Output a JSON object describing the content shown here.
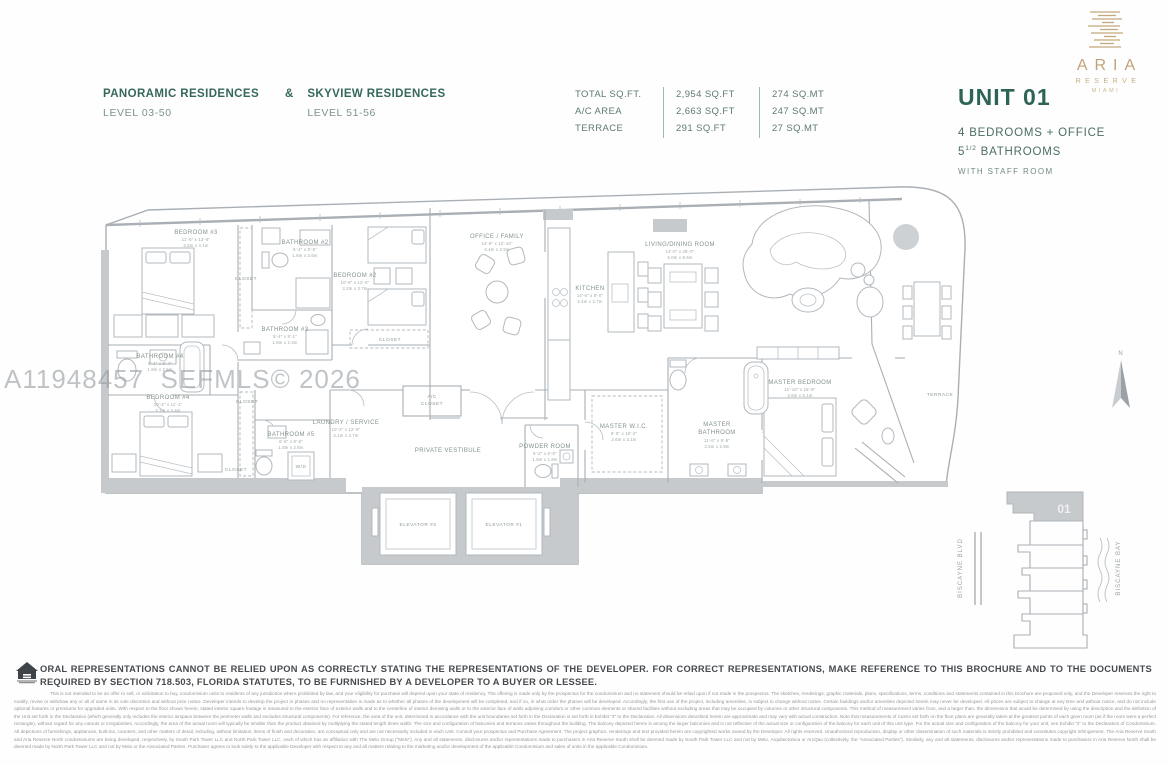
{
  "header": {
    "left": {
      "title1": "PANORAMIC RESIDENCES",
      "amp": "&",
      "title2": "SKYVIEW RESIDENCES",
      "sub1": "LEVEL 03-50",
      "sub2": "LEVEL 51-56"
    },
    "area_table": {
      "rows": [
        {
          "label": "TOTAL SQ.FT.",
          "sqft": "2,954 SQ.FT",
          "sqmt": "274 SQ.MT"
        },
        {
          "label": "A/C AREA",
          "sqft": "2,663 SQ.FT",
          "sqmt": "247 SQ.MT"
        },
        {
          "label": "TERRACE",
          "sqft": "291 SQ.FT",
          "sqmt": "27 SQ.MT"
        }
      ]
    },
    "brand": {
      "name": "ARIA",
      "reserve": "RESERVE",
      "city": "MIAMI",
      "gold": "#c3a87c"
    },
    "unit": {
      "title": "UNIT 01",
      "line1": "4 BEDROOMS + OFFICE",
      "line2_num": "5",
      "line2_frac": "1/2",
      "line2_rest": " BATHROOMS",
      "line3": "WITH STAFF ROOM",
      "accent": "#2e6456"
    }
  },
  "watermark": "A11948457  SEFMLS© 2026",
  "plan": {
    "rooms": {
      "b3": {
        "label": "BEDROOM #3",
        "ft": "11'-6\" x 13'-6\"",
        "m": "3.5m x 4.1m"
      },
      "ba2": {
        "label": "BATHROOM #2",
        "ft": "5'-4\" x 8'-6\"",
        "m": "1.6m x 2.6m"
      },
      "clo1": {
        "label": "CLOSET"
      },
      "ba3": {
        "label": "BATHROOM #3",
        "ft": "5'-4\" x 8'-1\"",
        "m": "1.6m x 2.4m"
      },
      "b2": {
        "label": "BEDROOM #2",
        "ft": "10'-8\" x 12'-0\"",
        "m": "3.2m x 3.7m"
      },
      "clo2": {
        "label": "CLOSET"
      },
      "ba4": {
        "label": "BATHROOM #4",
        "ft": "6'-1\" x 8'-4\"",
        "m": "1.9m x 2.5m"
      },
      "b4": {
        "label": "BEDROOM #4",
        "ft": "10'-2\" x 11'-1\"",
        "m": "3.1m x 3.4m"
      },
      "clo3": {
        "label": "CLOSET"
      },
      "clo4": {
        "label": "CLOSET"
      },
      "ba5": {
        "label": "BATHROOM #5",
        "ft": "6'-8\" x 8'-6\"",
        "m": "1.8m x 2.6m"
      },
      "wd": {
        "label": "W/D"
      },
      "laundry": {
        "label": "LAUNDRY / SERVICE",
        "ft": "10'-2\" x 12'-6\"",
        "m": "3.1m x 3.7m"
      },
      "office": {
        "label": "OFFICE / FAMILY",
        "ft": "14'-6\" x 12'-10\"",
        "m": "4.4m x 3.9m"
      },
      "kitchen": {
        "label": "KITCHEN",
        "ft": "14'-6\" x 9'-0\"",
        "m": "4.4m x 2.7m"
      },
      "living": {
        "label": "LIVING/DINING ROOM",
        "ft": "13'-0\" x 28'-0\"",
        "m": "4.0m x 8.5m"
      },
      "mbr": {
        "label": "MASTER BEDROOM",
        "ft": "11'-10\" x 16'-8\"",
        "m": "3.6m x 5.1m"
      },
      "wic": {
        "label": "MASTER W.I.C.",
        "ft": "8'-5\" x 10'-2\"",
        "m": "2.6m x 3.1m"
      },
      "mba": {
        "l1": "MASTER",
        "l2": "BATHROOM",
        "ft": "11'-6\" x 9'-5\"",
        "m": "3.5m x 2.9m"
      },
      "powder": {
        "label": "POWDER ROOM",
        "ft": "5'-2\" x 6'-0\"",
        "m": "1.6m x 1.8m"
      },
      "ac": {
        "l1": "A/C",
        "l2": "CLOSET"
      },
      "vest": {
        "label": "PRIVATE VESTIBULE"
      },
      "el2": {
        "label": "ELEVATOR #2"
      },
      "el1": {
        "label": "ELEVATOR #1"
      },
      "terrace": {
        "label": "TERRACE"
      }
    }
  },
  "keyplan": {
    "unit": "01",
    "road": "BISCAYNE BLVD",
    "bay": "BISCAYNE BAY",
    "north": "N"
  },
  "footer": {
    "bold": "ORAL REPRESENTATIONS CANNOT BE RELIED UPON AS CORRECTLY STATING THE REPRESENTATIONS OF THE DEVELOPER. FOR CORRECT REPRESENTATIONS, MAKE REFERENCE TO THIS BROCHURE AND TO THE DOCUMENTS REQUIRED BY SECTION 718.503, FLORIDA STATUTES, TO BE FURNISHED BY A DEVELOPER TO A BUYER OR LESSEE.",
    "fine_print": "This is not intended to be an offer to sell, or solicitation to buy, condominium units to residents of any jurisdiction where prohibited by law, and your eligibility for purchase will depend upon your state of residency. The offering is made only by the prospectus for the condominium and no statement should be relied upon if not made in the prospectus. The sketches, renderings, graphic materials, plans, specifications, terms, conditions and statements contained in this brochure are proposed only, and the Developer reserves the right to modify, revise or withdraw any or all of same in its sole discretion and without prior notice. Developer intends to develop the project in phases and no representation is made as to whether all phases of the development will be completed, and if so, in what order the phases will be developed. Accordingly, the first use of the project, including amenities, is subject to change without notice. Certain buildings and/or amenities depicted herein may never be developed. All prices are subject to change at any time and without notice, and do not include optional features or premiums for upgraded units. With respect to the floor shown herein, stated interior square footage is measured to the exterior face of exterior walls and to the centerline of interior demising walls or to the exterior face of walls adjoining corridors or other common elements or shared facilities without excluding areas that may be occupied by columns or other structural components. This method of measurement varies from, and a larger than, the dimensions that would be determined by using the description and the definition of the Unit set forth in the Declaration (which generally only includes the interior airspace between the perimeter walls and excludes structural components). For reference, the area of the unit, determined in accordance with the unit boundaries set forth in the Declaration is set forth in Exhibit \"3\" to the Declaration. All dimensions described herein are approximate and may vary with actual construction. Note that measurements of rooms set forth on the floor plans are generally taken at the greatest points of each given room (as if the room were a perfect rectangle), without regard for any cutouts or irregularities. Accordingly, the area of the actual room will typically be smaller than the product obtained by multiplying the stated length times width. The size and configuration of balconies and terraces varies throughout the building. The balcony depicted herein is among the larger balconies and is not reflective of the actual size or configuration of the balcony for each unit of this unit type. For the actual size and configuration of the balcony for your unit, see Exhibit \"2\" to the Declaration of Condominium. All depictions of furnishings, appliances, built-ins, counters, and other matters of detail, including, without limitation, items of finish and decoration, are conceptual only and are not necessarily included in each Unit. Consult your prospectus and Purchase Agreement. The project graphics, renderings and text provided herein are copyrighted works owned by the Developer. All rights reserved. Unauthorized reproduction, display or other dissemination of such materials is strictly prohibited and constitutes copyright infringement. The Aria Reserve South and Aria Reserve North condominiums are being developed, respectively, by South Park Tower LLC and North Park Tower LLC, each of which has an affiliation with The Melo Group (\"Melo\"). Any and all statements, disclosures and/or representations made to purchasers in Aria Reserve South shall be deemed made by South Park Tower LLC and not by Melo, Arquitectonica or ArcQao (collectively, the \"Associated Parties\"). Similarly, any and all statements, disclosures and/or representations made to purchasers in Aria Reserve North shall be deemed made by North Park Tower LLC and not by Melo or the Associated Parties. Purchaser agrees to look solely to the applicable Developer with respect to any and all matters relating to the marketing and/or development of the applicable Condominium and sales of units in the applicable Condominium."
  }
}
